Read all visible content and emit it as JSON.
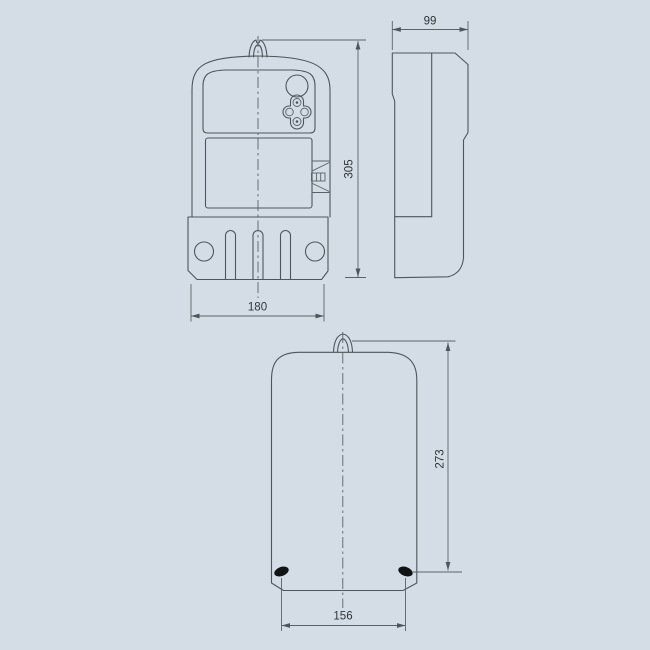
{
  "page": {
    "background_color": "#d4dde6",
    "line_color": "#4e555c",
    "text_color": "#2f343a"
  },
  "drawing": {
    "type": "technical-outline-drawing",
    "subject": "electricity meter overall and mounting dimensions",
    "views": [
      {
        "id": "front-view",
        "dimensions": {
          "width": "180",
          "height": "305"
        }
      },
      {
        "id": "side-view",
        "dimensions": {
          "depth": "99"
        }
      },
      {
        "id": "rear-view",
        "dimensions": {
          "height": "273",
          "hole_spacing": "156"
        }
      }
    ],
    "labels": {
      "front_width": "180",
      "front_height": "305",
      "side_depth": "99",
      "rear_height": "273",
      "rear_hole_spacing": "156"
    }
  }
}
